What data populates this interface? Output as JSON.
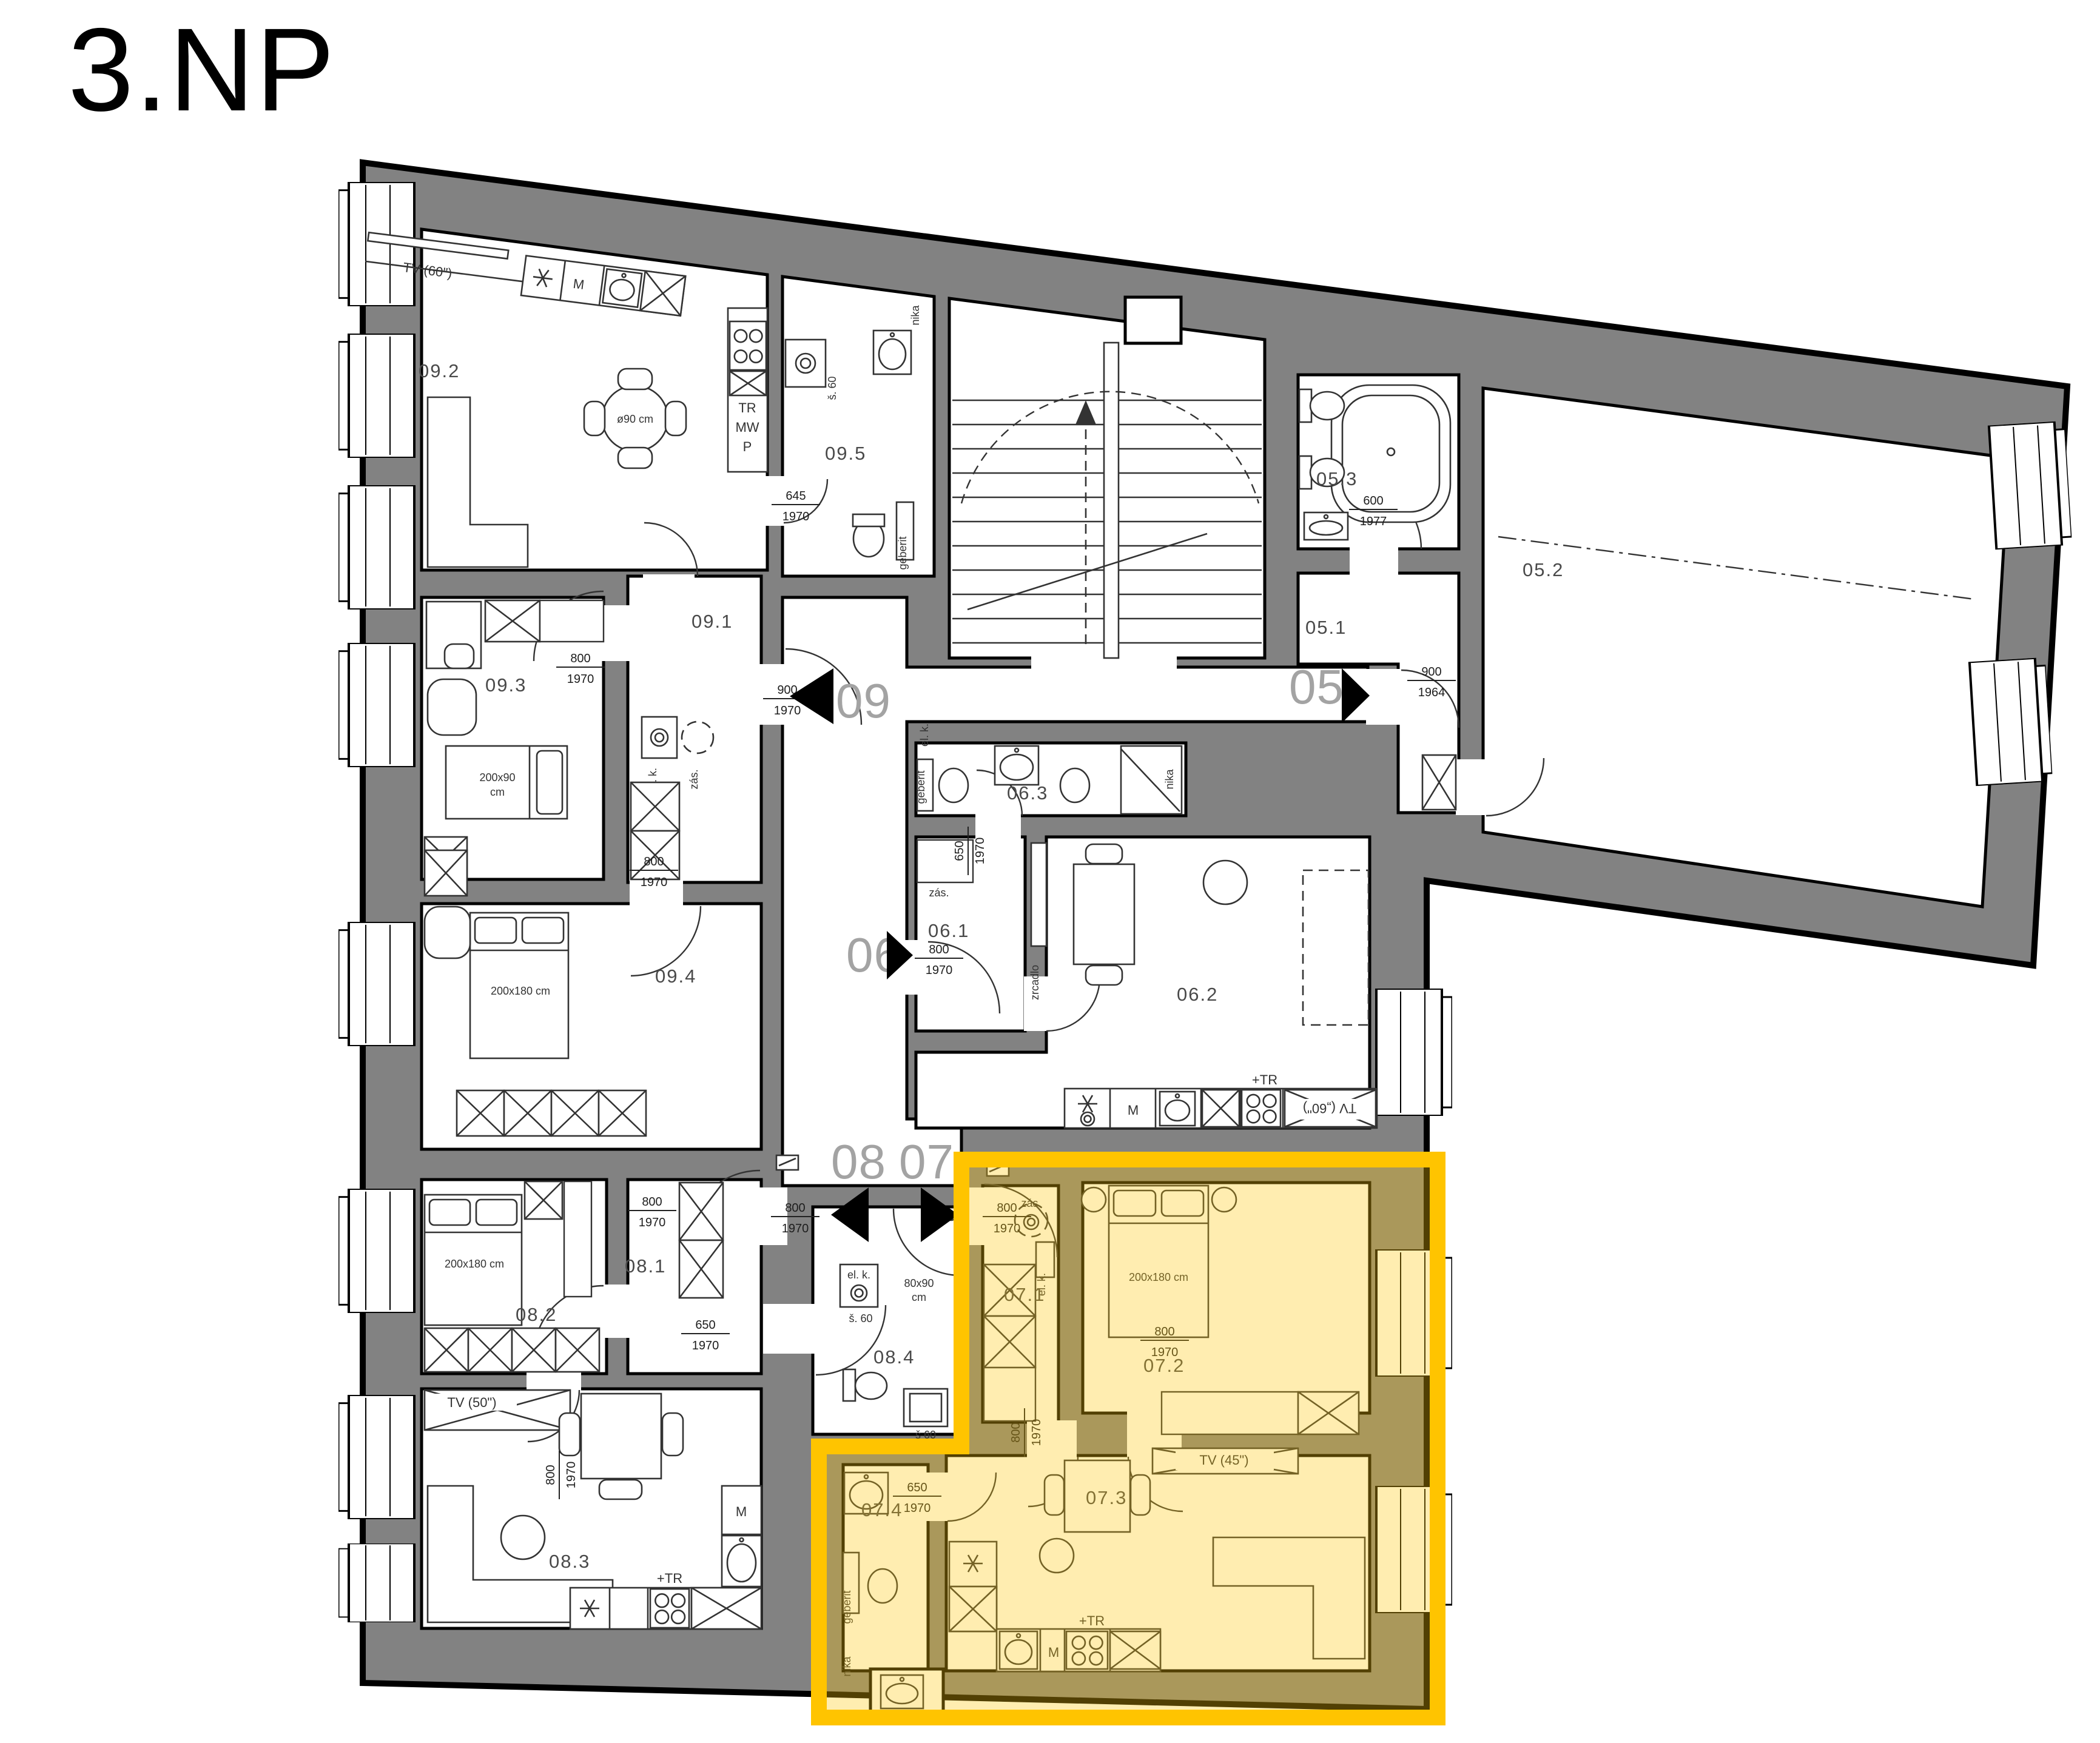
{
  "title": "3.NP",
  "units": {
    "u05": "05",
    "u06": "06",
    "u07": "07",
    "u08": "08",
    "u09": "09"
  },
  "rooms": {
    "r051": "05.1",
    "r052": "05.2",
    "r053": "05.3",
    "r061": "06.1",
    "r062": "06.2",
    "r063": "06.3",
    "r071": "07.1",
    "r072": "07.2",
    "r073": "07.3",
    "r074": "07.4",
    "r081": "08.1",
    "r082": "08.2",
    "r083": "08.3",
    "r084": "08.4",
    "r091": "09.1",
    "r092": "09.2",
    "r093": "09.3",
    "r094": "09.4",
    "r095": "09.5"
  },
  "dims": {
    "d645_1970": {
      "w": "645",
      "h": "1970"
    },
    "d800_1970": {
      "w": "800",
      "h": "1970"
    },
    "d900_1970": {
      "w": "900",
      "h": "1970"
    },
    "d900_1964": {
      "w": "900",
      "h": "1964"
    },
    "d600_1977": {
      "w": "600",
      "h": "1977"
    },
    "d650_1970": {
      "w": "650",
      "h": "1970"
    }
  },
  "labels": {
    "tv60": "TV (60\")",
    "tv60_mirror": "TV („60\")",
    "tv50": "TV (50\")",
    "tv45": "TV (45\")",
    "table_round": "ø90 cm",
    "bed_single_1": "200x90",
    "bed_single_2": "cm",
    "bed_double": "200x180 cm",
    "shower_1": "80x90",
    "shower_2": "cm",
    "washer": "š. 60",
    "washer_b": "š 60",
    "tall_1": "TR",
    "tall_2": "MW",
    "tall_3": "P",
    "microwave": "M",
    "stove": "+TR",
    "el_k": "el. k.",
    "zas": "zás.",
    "zrcadlo": "zrcadlo",
    "geberit": "geberit",
    "nika": "nika"
  },
  "colors": {
    "wall": "#828282",
    "room": "#ffffff",
    "highlight_border": "#ffc400",
    "highlight_fill": "#ffc80a",
    "text": "#444444",
    "unit_text": "#a3a3a3"
  }
}
